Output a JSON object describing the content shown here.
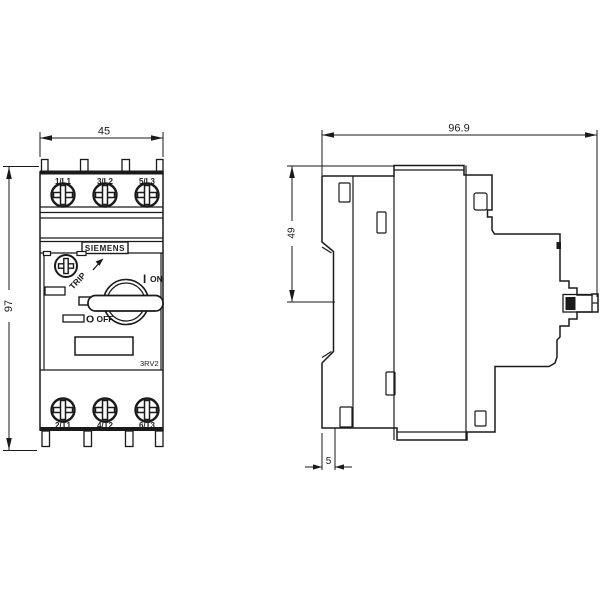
{
  "front_view": {
    "width_dim": "45",
    "height_dim": "97",
    "terminals_top": [
      "1/L1",
      "3/L2",
      "5/L3"
    ],
    "terminals_bottom": [
      "2/T1",
      "4/T2",
      "6/T3"
    ],
    "brand": "SIEMENS",
    "model": "3RV2",
    "trip_label": "TRIP",
    "on_symbol": "I",
    "on_label": "ON",
    "off_symbol": "O",
    "off_label": "OFF"
  },
  "side_view": {
    "width_dim": "96.9",
    "height_dim": "49",
    "offset_dim": "5"
  },
  "colors": {
    "line": "#1a1a1a",
    "background": "#ffffff"
  }
}
